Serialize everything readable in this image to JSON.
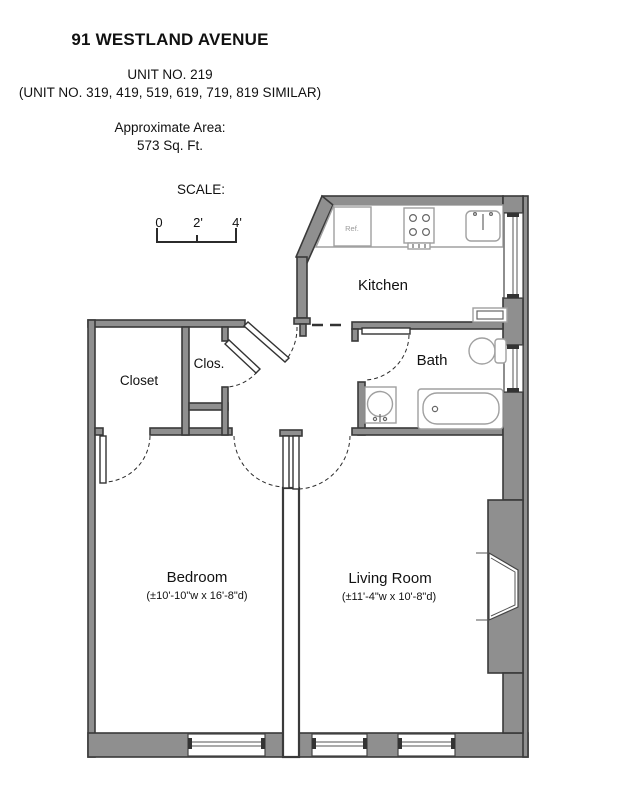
{
  "header": {
    "address": "91 WESTLAND AVENUE",
    "unit": "UNIT NO. 219",
    "similar": "(UNIT NO. 319, 419, 519, 619, 719, 819 SIMILAR)",
    "area_label": "Approximate Area:",
    "area_value": "573 Sq. Ft.",
    "scale_label": "SCALE:",
    "scale_ticks": [
      "0",
      "2'",
      "4'"
    ]
  },
  "rooms": {
    "kitchen": {
      "label": "Kitchen"
    },
    "bath": {
      "label": "Bath"
    },
    "closet": {
      "label": "Closet"
    },
    "clos": {
      "label": "Clos."
    },
    "bedroom": {
      "label": "Bedroom",
      "dims": "(±10'-10\"w x 16'-8\"d)"
    },
    "living_room": {
      "label": "Living Room",
      "dims": "(±11'-4\"w x 10'-8\"d)"
    }
  },
  "fixtures": {
    "refrigerator_label": "Ref."
  },
  "colors": {
    "wall_fill": "#8f8f8f",
    "wall_stroke": "#3a3a3a",
    "line_dark": "#2b2b2b",
    "fixture_stroke": "#a0a0a0",
    "text": "#111111",
    "muted_text": "#9a9a9a",
    "bg": "#ffffff"
  }
}
